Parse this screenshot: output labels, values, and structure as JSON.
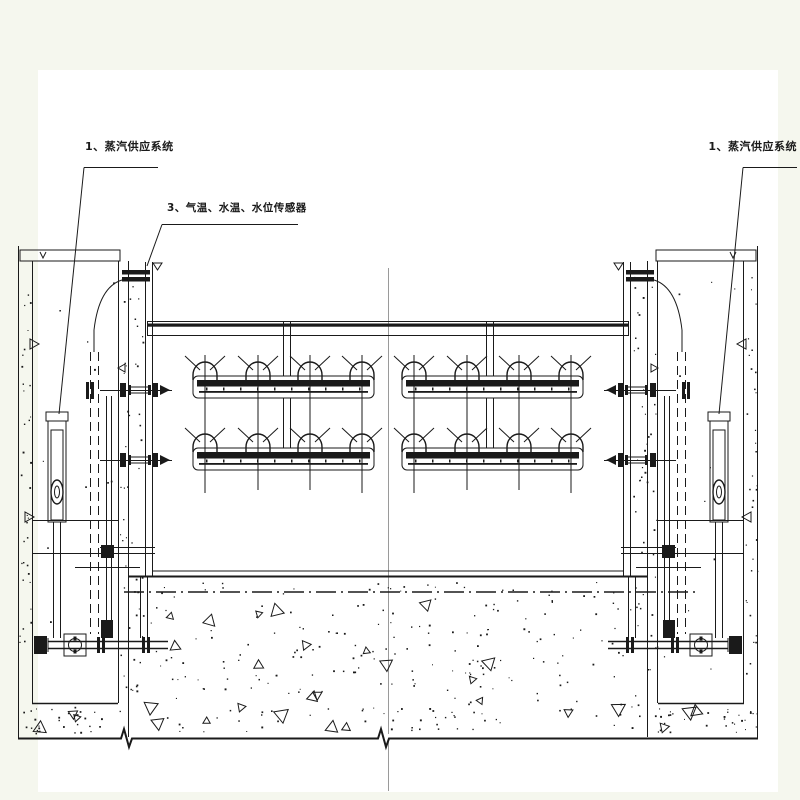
{
  "drawing": {
    "title": "steam-heating-tank-section",
    "labels": {
      "steam_left": "1、蒸汽供应系统",
      "sensors": "3、气温、水温、水位传感器",
      "steam_right": "1、蒸汽供应系统"
    },
    "colors": {
      "line": "#1a1a1a",
      "centerline": "#9a9a9a",
      "sheet": "#ffffff",
      "margin": "#f5f7ee"
    }
  }
}
